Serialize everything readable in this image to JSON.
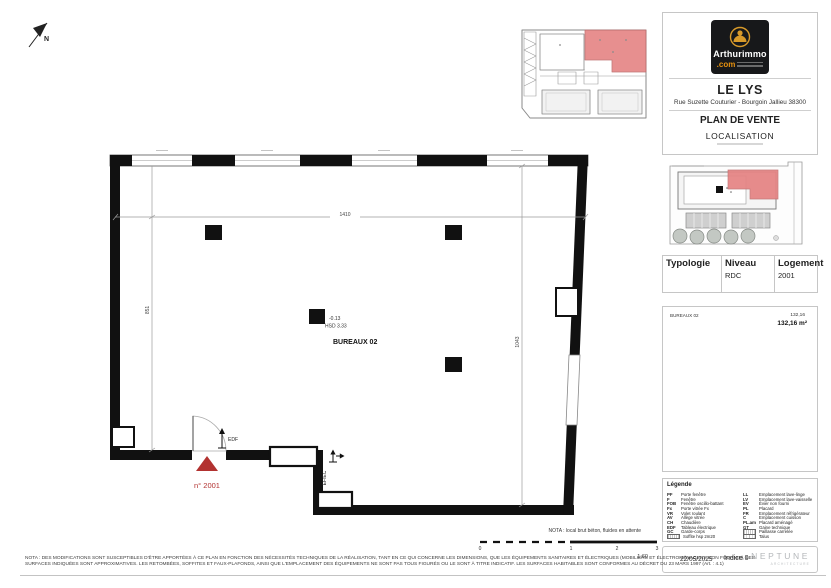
{
  "page": {
    "north": "N",
    "logo": {
      "brand": "Arthurimmo",
      "tld": ".com"
    },
    "header": {
      "title": "LE LYS",
      "address": "Rue Suzette Couturier - Bourgoin Jallieu 38300",
      "doc_type": "PLAN DE VENTE",
      "section": "LOCALISATION"
    },
    "typology": {
      "headers": [
        "Typologie",
        "Niveau",
        "Logement"
      ],
      "values": [
        "",
        "RDC",
        "2001"
      ]
    },
    "surface": {
      "room": "BUREAUX 02",
      "area": "132,16",
      "total": "132,16 m²"
    },
    "legend": {
      "title": "Légende",
      "left": [
        {
          "abbr": "PF",
          "label": "Porte fenêtre"
        },
        {
          "abbr": "F",
          "label": "Fenêtre"
        },
        {
          "abbr": "FOB",
          "label": "Fenêtre oscillo-battant"
        },
        {
          "abbr": "Fx",
          "label": "Porte vitrée Fx"
        },
        {
          "abbr": "VR",
          "label": "Volet roulant"
        },
        {
          "abbr": "AV",
          "label": "Allège vitrée"
        },
        {
          "abbr": "CH",
          "label": "Chaudière"
        },
        {
          "abbr": "EDF",
          "label": "Tableau électrique"
        },
        {
          "abbr": "GC",
          "label": "Garde-corps"
        },
        {
          "abbr": "",
          "label": "Soffite hsp 2m20"
        }
      ],
      "right": [
        {
          "abbr": "LL",
          "label": "Emplacement lave-linge"
        },
        {
          "abbr": "LV",
          "label": "Emplacement lave-vaisselle"
        },
        {
          "abbr": "EV",
          "label": "Évier non fourni"
        },
        {
          "abbr": "PL",
          "label": "Placard"
        },
        {
          "abbr": "FR",
          "label": "Emplacement réfrigérateur"
        },
        {
          "abbr": "C",
          "label": "Emplacement cuisson"
        },
        {
          "abbr": "PL.am",
          "label": "Placard aménagé"
        },
        {
          "abbr": "GT",
          "label": "Gaine technique"
        },
        {
          "abbr": "",
          "label": "Paillasse carrelée"
        },
        {
          "abbr": "",
          "label": "Talus"
        }
      ]
    },
    "footer": {
      "date": "22/05/2025",
      "indice": "Indice 0",
      "architect": "NEPTUNE",
      "architect_sub": "ARCHITECTURE"
    },
    "nota": {
      "line1": "NOTA : DES MODIFICATIONS SONT SUSCEPTIBLES D'ÊTRE APPORTÉES À CE PLAN EN FONCTION DES NÉCESSITÉS TECHNIQUES DE LA RÉALISATION, TANT EN CE QUI CONCERNE LES DIMENSIONS, QUE LES ÉQUIPEMENTS SANITAIRES ET ÉLECTRIQUES (MOBILIERS ET ÉLECTROMÉNAGERS NON FOURNIS), LES",
      "line2": "SURFACES INDIQUÉES SONT APPROXIMATIVES. LES RETOMBÉES, SOFFITES ET FAUX-PLAFONDS, AINSI QUE L'EMPLACEMENT DES ÉQUIPEMENTS NE SONT PAS TOUS FIGURÉS OU LE SONT À TITRE INDICATIF. LES SURFACES HABITABLES SONT CONFORMES AU DÉCRET DU 23 MARS 1997 (Art. : 4.1)"
    }
  },
  "plan": {
    "room": "BUREAUX 02",
    "level": "-0.13",
    "hsd": "HSD 3.33",
    "lot": "n° 2001",
    "edf": "EDF",
    "efec": "EF/EC",
    "dims": {
      "top": "1410",
      "left": "851",
      "right": "1043"
    },
    "nota": "NOTA : local brut béton, fluides en attente",
    "scale": {
      "t0": "0",
      "t1": "1",
      "t2": "2",
      "t3": "3",
      "ratio": "1:60"
    }
  },
  "colors": {
    "accent_red": "#b23230",
    "map_red": "#e58383",
    "logo_gold": "#d89a2a",
    "logo_bg": "#17181a",
    "neptune_gray": "#b4b7ba"
  }
}
